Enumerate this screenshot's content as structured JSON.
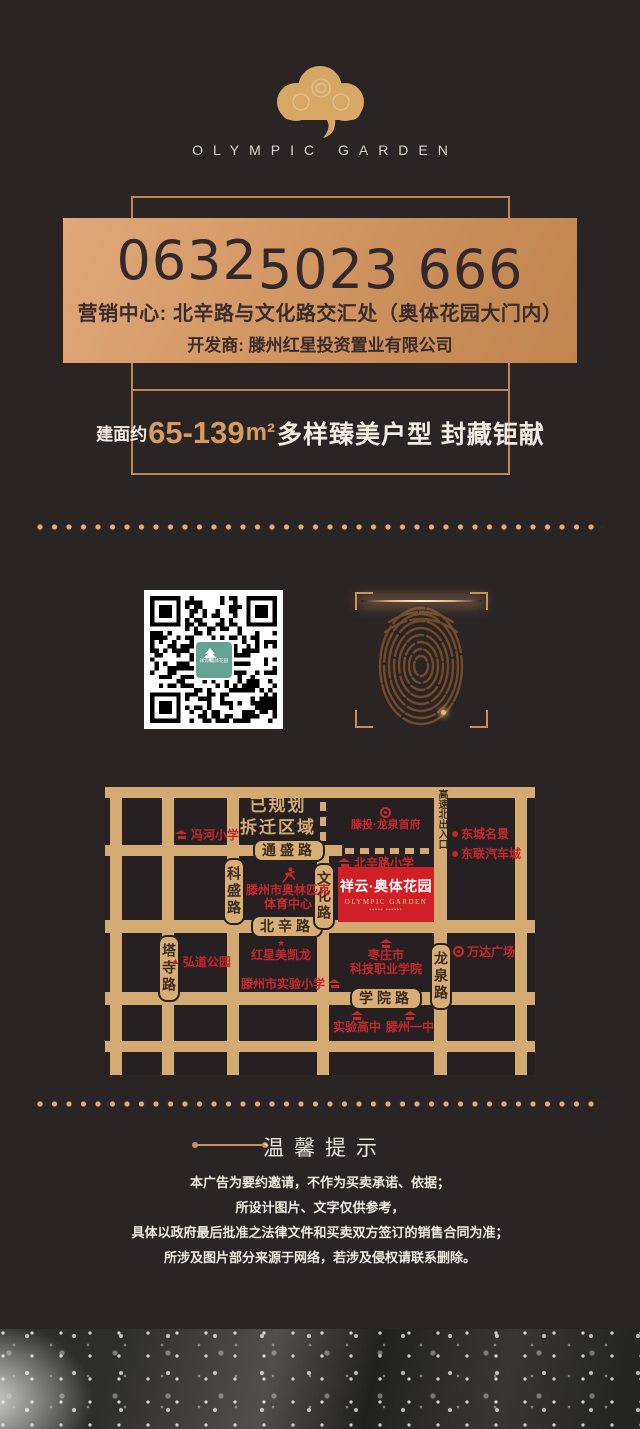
{
  "brand": {
    "name": "OLYMPIC GARDEN"
  },
  "hero": {
    "phone_area_code": "0632",
    "phone_number": "5023 666",
    "marketing_center": "营销中心: 北辛路与文化路交汇处（奥体花园大门内）",
    "developer": "开发商: 滕州红星投资置业有限公司"
  },
  "offer": {
    "prefix": "建面约",
    "range": "65-139",
    "unit": "m²",
    "tagline": "多样臻美户型 封藏钜献"
  },
  "scan": {
    "qr_logo_title": "祥云·奥体花园"
  },
  "map": {
    "planned_zone_line1": "已规划",
    "planned_zone_line2": "拆迁区域",
    "roads": {
      "tongsheng": "通盛路",
      "beixin": "北辛路",
      "xueyuan": "学院路",
      "kesheng": "科盛路",
      "wenhua": "文化路",
      "tasi": "塔寺路",
      "longquan": "龙泉路",
      "expressway": "高速北出入口"
    },
    "project": {
      "name": "祥云·奥体花园",
      "latin": "OLYMPIC GARDEN",
      "tagline_marks": "▪▪▪▪▪ ▪▪▪▪▪▪"
    },
    "pois": {
      "fenghe": "冯河小学",
      "longquanfu": "滕投·龙泉首府",
      "dongcheng": "东城名景",
      "donglian": "东联汽车城",
      "beixin_primary": "北辛路小学",
      "olympic1": "滕州市奥林匹克",
      "olympic2": "体育中心",
      "hongxing": "红星美凯龙",
      "hongdao": "弘道公园",
      "shiyan_primary": "滕州市实验小学",
      "zaozhuang1": "枣庄市",
      "zaozhuang2": "科技职业学院",
      "wanda": "万达广场",
      "shiyan_high": "实验高中",
      "tengzhou1": "滕州一中"
    }
  },
  "tips": {
    "title": "温馨提示",
    "lines": [
      "本广告为要约邀请，不作为买卖承诺、依据；",
      "所设计图片、文字仅供参考，",
      "具体以政府最后批准之法律文件和买卖双方签订的销售合同为准；",
      "所涉及图片部分来源于网络，若涉及侵权请联系删除。"
    ]
  },
  "colors": {
    "background": "#2b2425",
    "gold": "#d2a96e",
    "red": "#c5272c",
    "project_red": "#d01f26"
  }
}
